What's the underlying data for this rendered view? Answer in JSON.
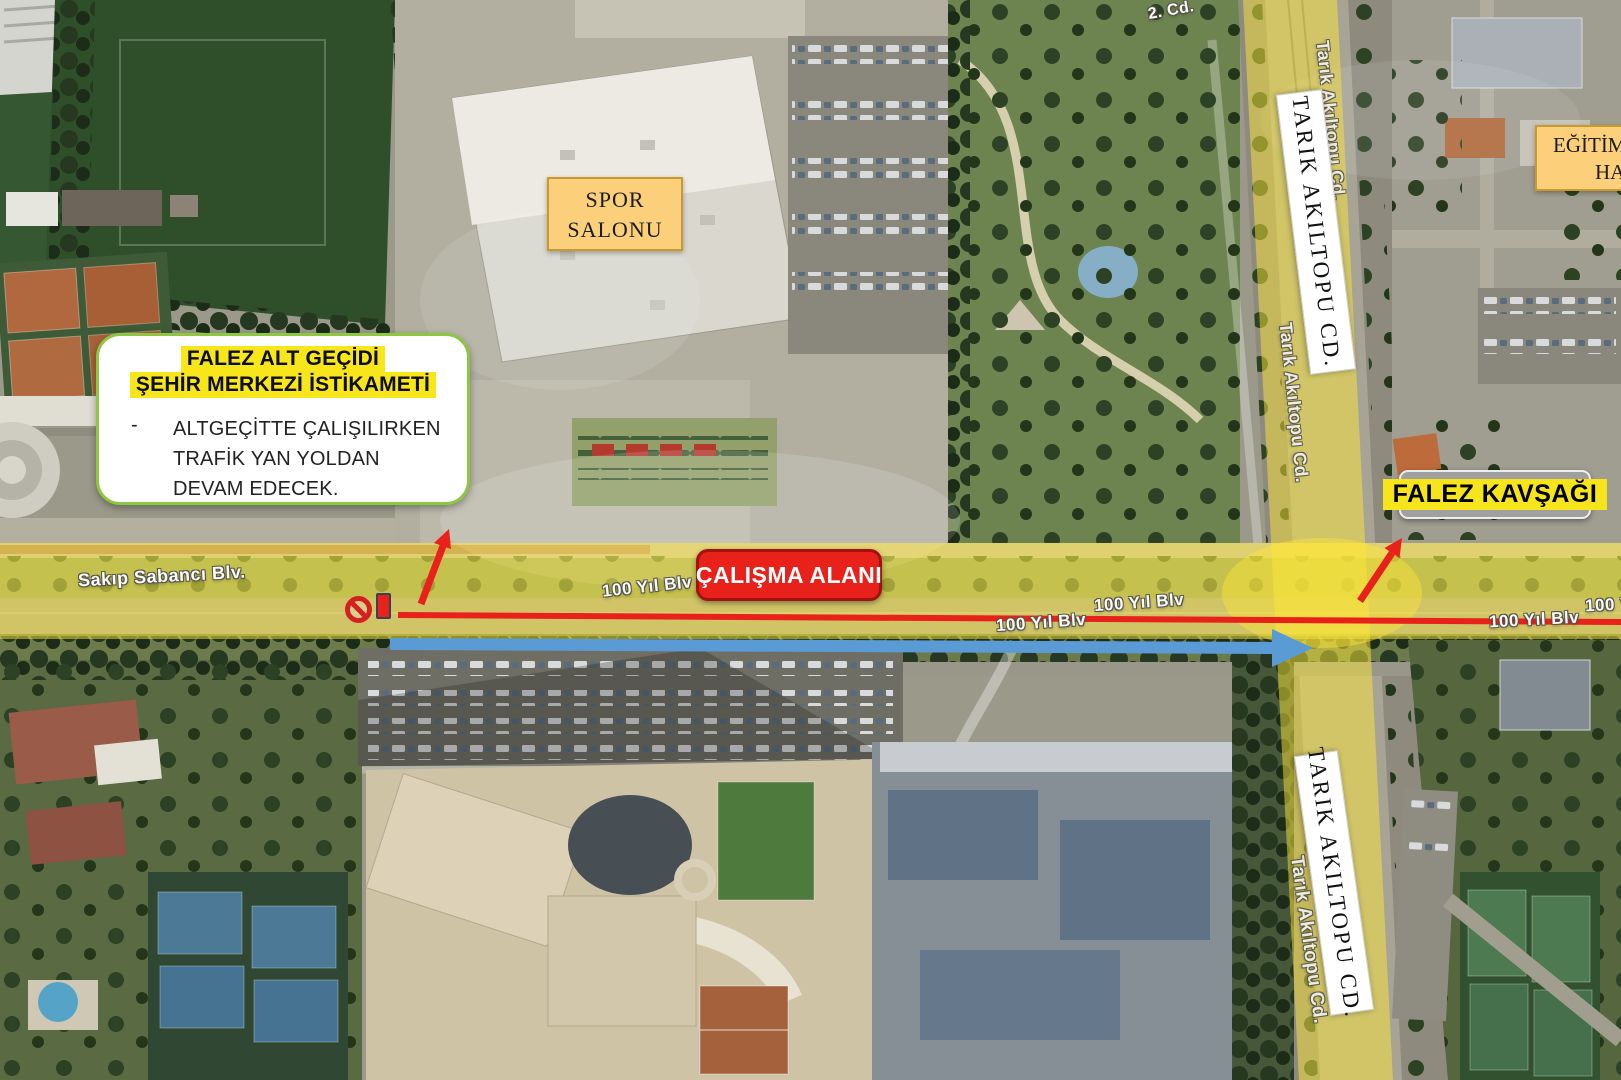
{
  "callout": {
    "title_line1": "FALEZ ALT GEÇİDİ",
    "title_line2": "ŞEHİR MERKEZİ İSTİKAMETİ",
    "bullet_dash": "-",
    "bullet_text": "ALTGEÇİTTE ÇALIŞILIRKEN TRAFİK YAN YOLDAN DEVAM EDECEK."
  },
  "labels": {
    "spor_salonu_line1": "SPOR",
    "spor_salonu_line2": "SALONU",
    "egitim_line1": "EĞİTİM",
    "egitim_line2": "HA",
    "tarik_akiltopu_top": "TARIK AKILTOPU CD.",
    "tarik_akiltopu_bottom": "TARIK AKILTOPU CD.",
    "falez_kavsagi": "FALEZ KAVŞAĞI",
    "calisma_alani": "ÇALIŞMA ALANI"
  },
  "map_labels": {
    "sakip_sabanci": "Sakıp Sabancı Blv.",
    "yuzyil": "100 Yıl Blv",
    "cd2": "2. Cd.",
    "tarik_faint": "Tarık Akıltopu Cd."
  },
  "colors": {
    "annotation_red": "#e8211a",
    "annotation_blue": "#5b9bd5",
    "highlight_yellow": "#f7e61a",
    "road_overlay_yellow": "rgba(252,230,58,0.5)",
    "callout_border_green": "#8dc63f",
    "spor_box_fill": "#fcd07a",
    "spor_box_border": "#c9992f",
    "kavsagi_gray": "#a0a0a0",
    "calisma_red": "#e8211a"
  }
}
